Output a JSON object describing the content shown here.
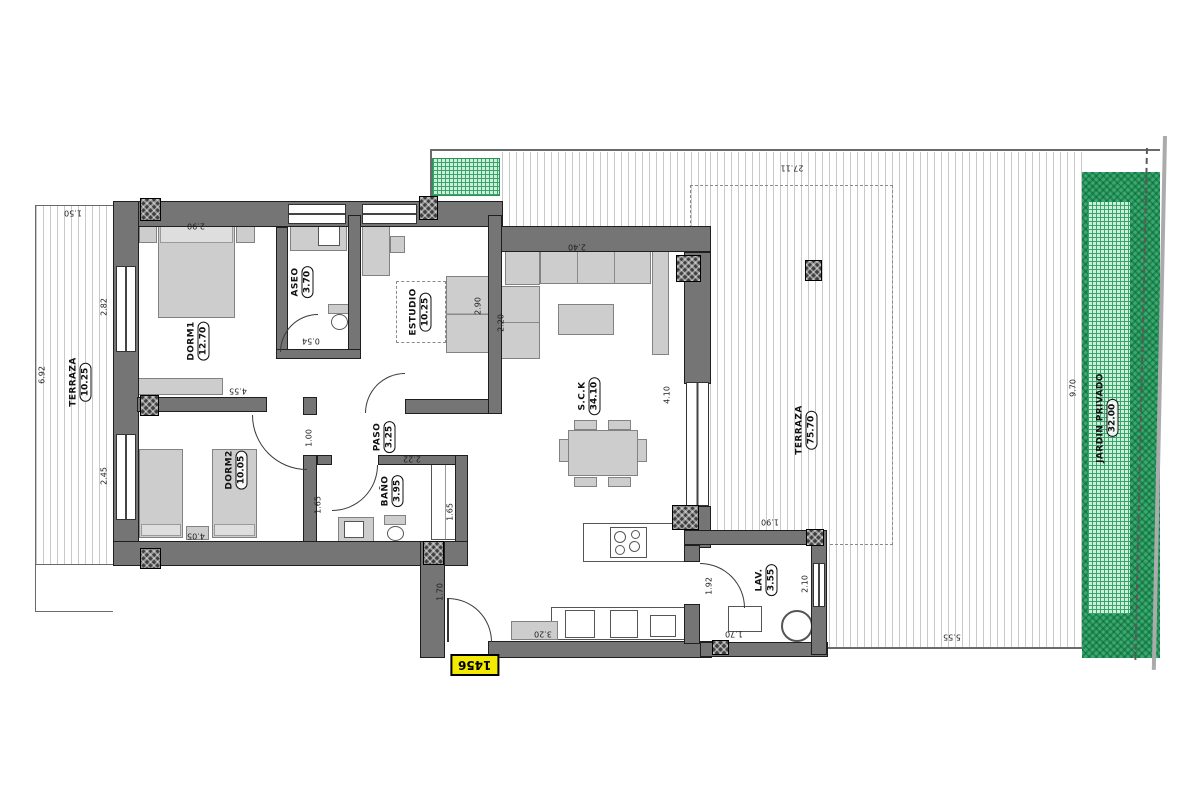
{
  "tag": {
    "text": "1456"
  },
  "rooms": [
    {
      "name": "TERRAZA",
      "area": "10.25"
    },
    {
      "name": "DORM1",
      "area": "12.70"
    },
    {
      "name": "ASEO",
      "area": "3.70"
    },
    {
      "name": "ESTUDIO",
      "area": "10.25"
    },
    {
      "name": "PASO",
      "area": "3.25"
    },
    {
      "name": "DORM2",
      "area": "10.05"
    },
    {
      "name": "BAÑO",
      "area": "3.95"
    },
    {
      "name": "S.C.K",
      "area": "34.10"
    },
    {
      "name": "LAV.",
      "area": "3.55"
    },
    {
      "name": "TERRAZA",
      "area": "75.70"
    },
    {
      "name": "JARDIN PRIVADO",
      "area": "32.00"
    }
  ],
  "dims": [
    {
      "v": "27.11"
    },
    {
      "v": "1.50"
    },
    {
      "v": "6.92"
    },
    {
      "v": "2.90"
    },
    {
      "v": "2.82"
    },
    {
      "v": "2.45"
    },
    {
      "v": "4.55"
    },
    {
      "v": "4.05"
    },
    {
      "v": "2.90"
    },
    {
      "v": "2.20"
    },
    {
      "v": "2.40"
    },
    {
      "v": "1.00"
    },
    {
      "v": "2.22"
    },
    {
      "v": "1.65"
    },
    {
      "v": "1.65"
    },
    {
      "v": "0.54"
    },
    {
      "v": "3.20"
    },
    {
      "v": "1.70"
    },
    {
      "v": "4.10"
    },
    {
      "v": "1.90"
    },
    {
      "v": "1.92"
    },
    {
      "v": "2.10"
    },
    {
      "v": "1.70"
    },
    {
      "v": "9.70"
    },
    {
      "v": "5.55"
    }
  ],
  "colors": {
    "wall": "#757575",
    "wall_edge": "#1f1f1f",
    "furniture": "#cdcdcd",
    "terrace_stripe": "#c9c9c9",
    "garden_dark": "#3aa96e",
    "garden_light": "#cdeeda",
    "tag_bg": "#f2ea00"
  }
}
